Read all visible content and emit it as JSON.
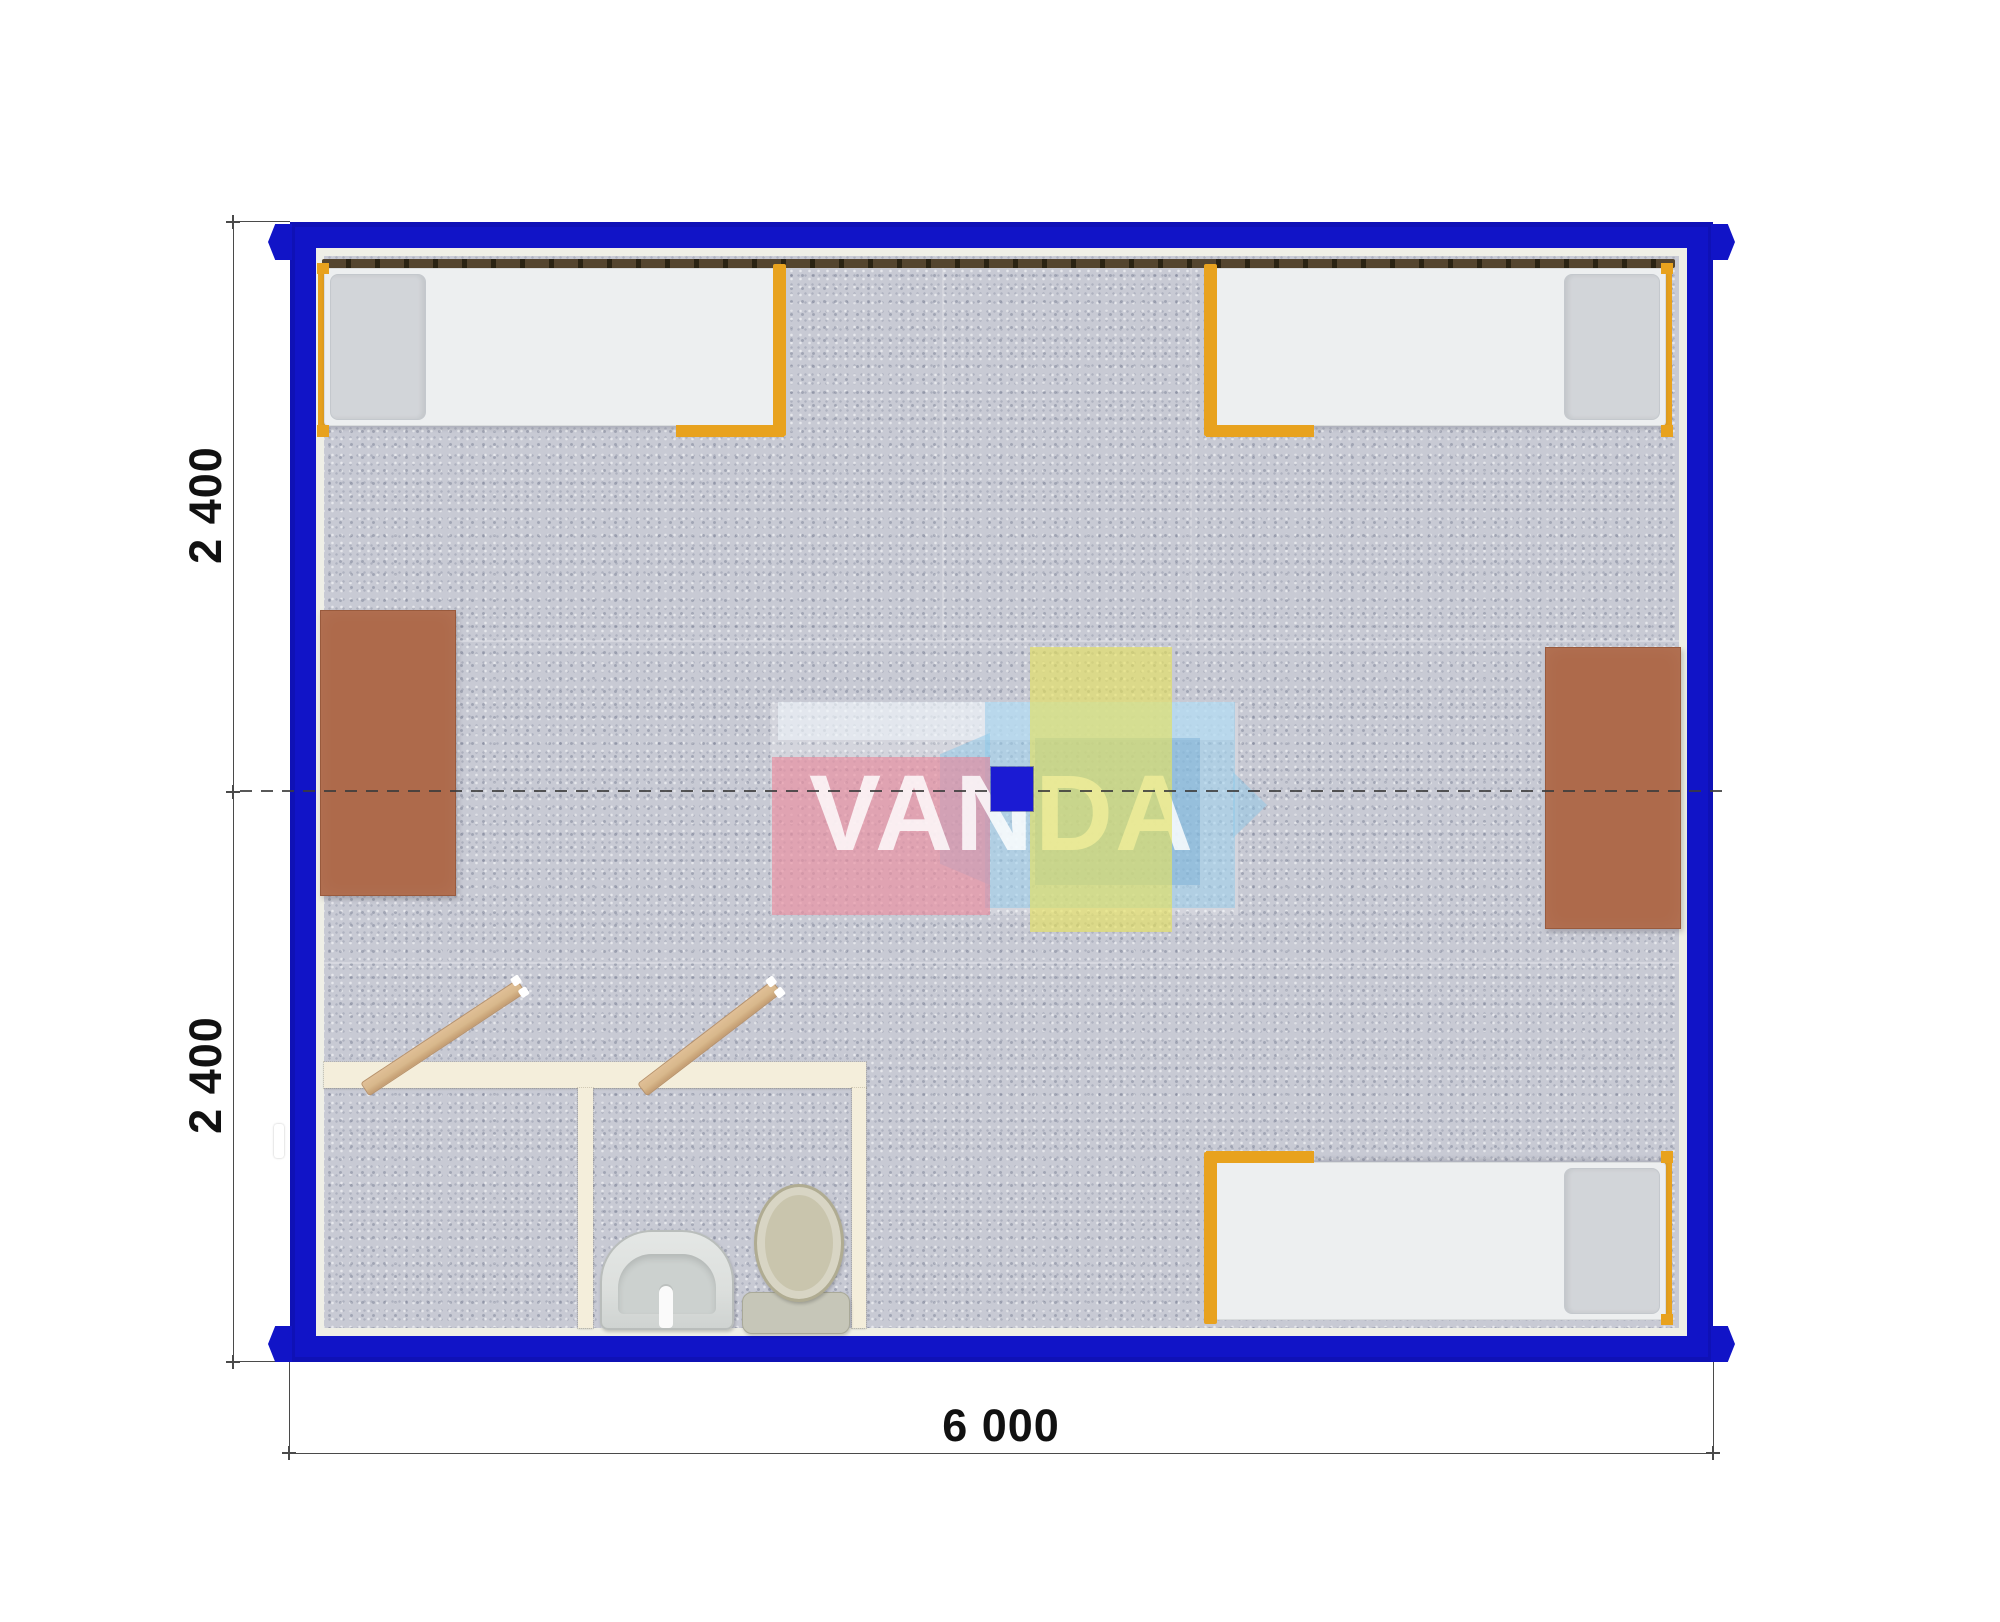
{
  "watermark": {
    "brand": "VANDA"
  },
  "dimensions": {
    "left_top": "2 400",
    "left_bottom": "2 400",
    "bottom": "6 000"
  },
  "elements": {
    "drawing": "container-cabin-floor-plan-top-view",
    "beds": [
      "bed-top-left",
      "bed-top-right",
      "bed-bottom-right"
    ],
    "desks": [
      "desk-left-wall",
      "desk-right-wall"
    ],
    "bathroom": [
      "storage-room",
      "wc-room",
      "toilet",
      "sink",
      "door-leaf-left",
      "door-leaf-right"
    ],
    "heater": "radiator-strip-top-wall",
    "window": "window-marker-left-wall",
    "axis": "center-axis-dashed-line",
    "corner_castings": [
      "top-left",
      "bottom-left",
      "top-right",
      "bottom-right"
    ]
  },
  "colors": {
    "wall_blue": "#1114c7",
    "lining": "#efefe6",
    "floor": "#c8cad4",
    "radiator": "#54452f",
    "radiator_dark": "#2a2313",
    "bed_frame": "#e8a21e",
    "mattress": "#edeff0",
    "pillow": "#d2d5d9",
    "desk_brown": "#ae6a4b",
    "bath_wall": "#f4eedb",
    "door_wood": "#d8b88c",
    "fixture": "#dcdfdd",
    "toilet_beige": "#c9c5ad",
    "dim_line": "#4a4a4a",
    "dim_text": "#111111",
    "wm_pink": "#e68ca4",
    "wm_yellow": "#e2de6c",
    "wm_sky": "#8cc8eb",
    "wm_blue": "#1b1bd3",
    "wm_text": "#ffffff"
  }
}
